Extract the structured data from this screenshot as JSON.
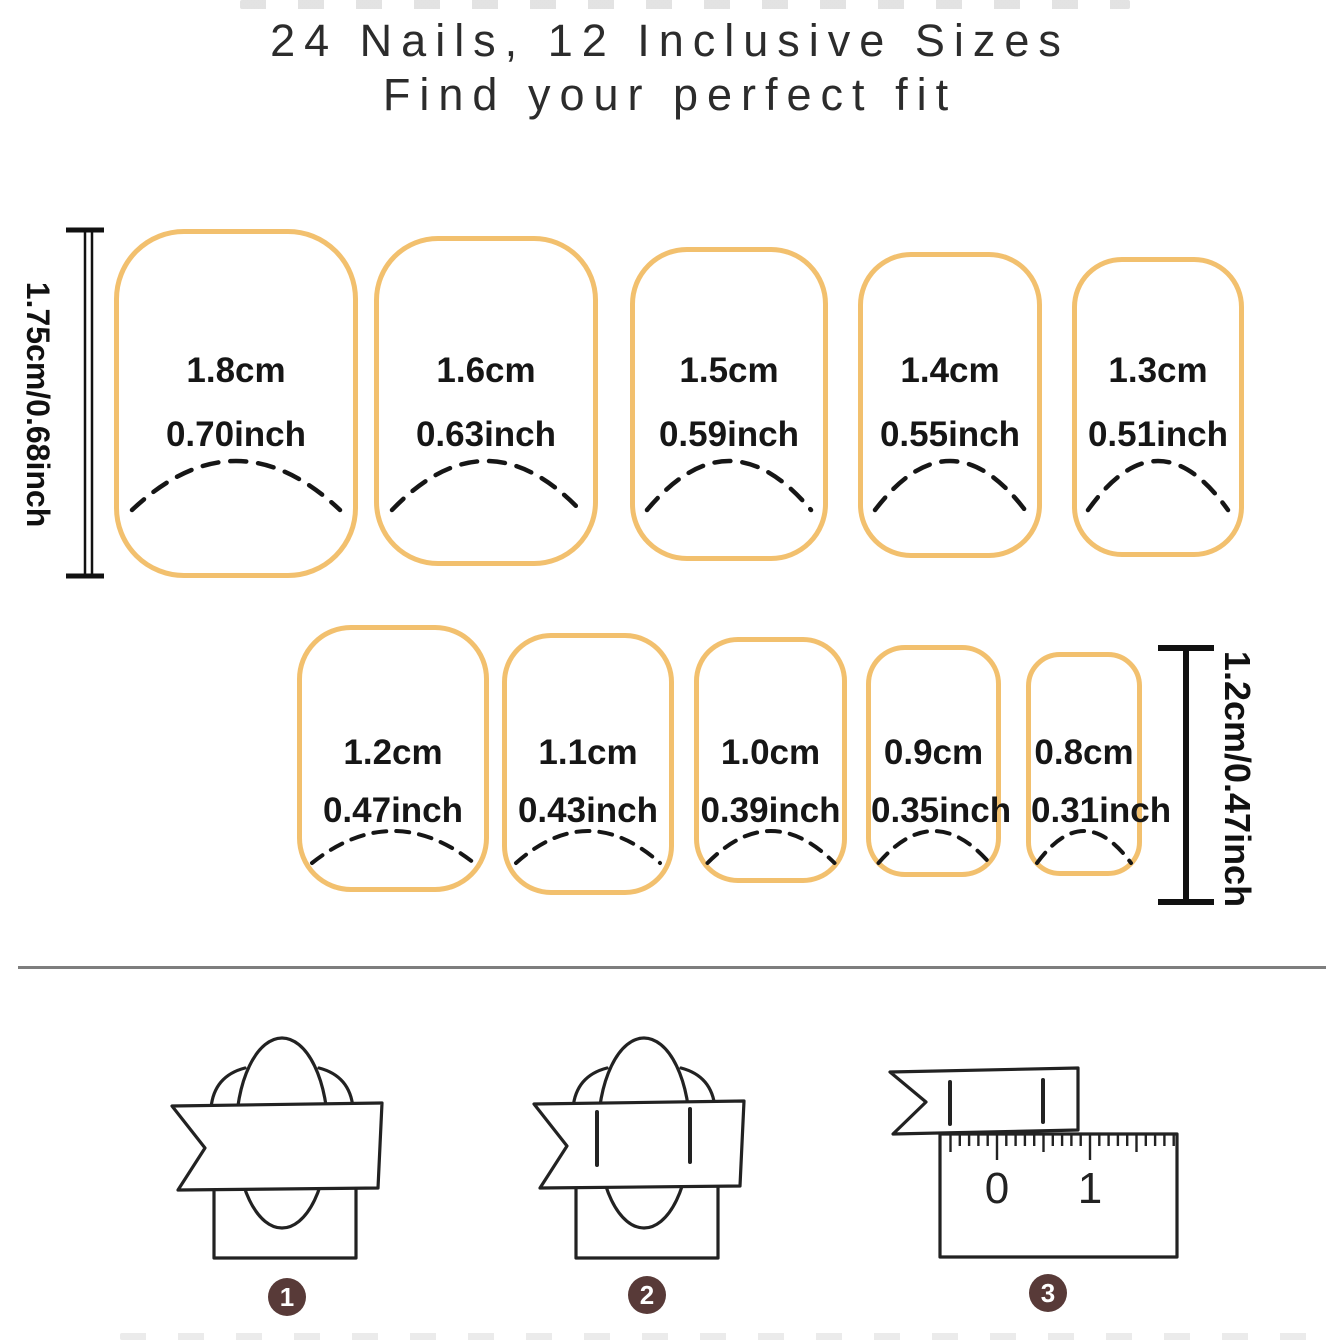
{
  "title": {
    "line1": "24 Nails, 12 Inclusive Sizes",
    "line2": "Find your perfect fit"
  },
  "colors": {
    "nail_outline": "#f2c06e",
    "text": "#1c1c1c",
    "divider": "#7e7e7e",
    "step_badge": "#583a38",
    "background": "#ffffff"
  },
  "size_chart": {
    "row1": {
      "height_label": "1.75cm/0.68inch",
      "nails": [
        {
          "cm": "1.8cm",
          "inch": "0.70inch"
        },
        {
          "cm": "1.6cm",
          "inch": "0.63inch"
        },
        {
          "cm": "1.5cm",
          "inch": "0.59inch"
        },
        {
          "cm": "1.4cm",
          "inch": "0.55inch"
        },
        {
          "cm": "1.3cm",
          "inch": "0.51inch"
        }
      ]
    },
    "row2": {
      "height_label": "1.2cm/0.47inch",
      "nails": [
        {
          "cm": "1.2cm",
          "inch": "0.47inch"
        },
        {
          "cm": "1.1cm",
          "inch": "0.43inch"
        },
        {
          "cm": "1.0cm",
          "inch": "0.39inch"
        },
        {
          "cm": "0.9cm",
          "inch": "0.35inch"
        },
        {
          "cm": "0.8cm",
          "inch": "0.31inch"
        }
      ]
    }
  },
  "steps": [
    {
      "number": "1"
    },
    {
      "number": "2"
    },
    {
      "number": "3",
      "ruler": {
        "label0": "0",
        "label1": "1"
      }
    }
  ]
}
